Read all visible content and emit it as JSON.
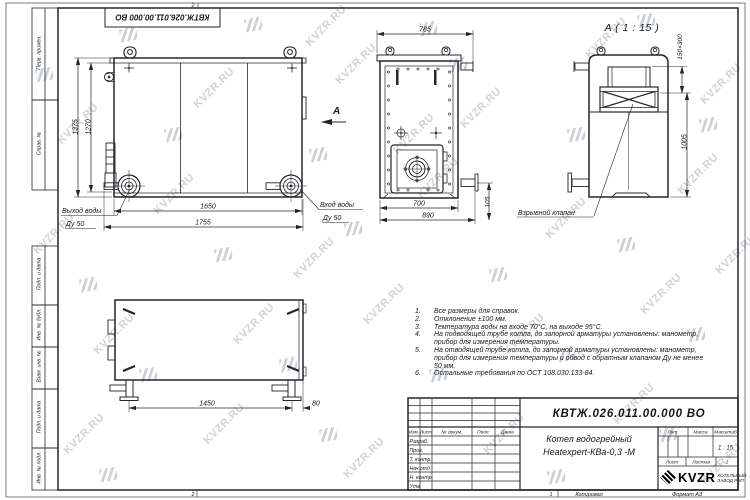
{
  "sheet": {
    "doc_box_top": "КВТЖ.026.011.00.000 ВО",
    "zone_top": "2",
    "zone_bottom_left": "2",
    "zone_bottom_right": "1",
    "copied_label": "Копировал",
    "format_label": "Формат А3"
  },
  "margin": {
    "perv": "Перв. примен.",
    "sprav": "Справ. №",
    "podp1": "Подп. и дата",
    "inv_dubl": "Инв. № дубл.",
    "vzam": "Взам. инв. №",
    "podp2": "Подп. и дата",
    "inv_podl": "Инв. № подл."
  },
  "front": {
    "dim_1375": "1375",
    "dim_1270": "1270",
    "dim_1650": "1650",
    "dim_1755": "1755",
    "outlet_line1": "Выход воды",
    "outlet_line2": "Ду 50",
    "inlet_line1": "Вход воды",
    "inlet_line2": "Ду 50",
    "arrow_label": "A"
  },
  "side": {
    "dim_785": "785",
    "dim_700": "700",
    "dim_890": "890",
    "dim_105": "105"
  },
  "viewA": {
    "title": "A ( 1 : 15 )",
    "dim_valve": "150×300",
    "dim_1005": "1005",
    "valve_label": "Взрывной клапан"
  },
  "bottom_view": {
    "dim_1450": "1450",
    "dim_80": "80"
  },
  "notes": [
    {
      "num": "1.",
      "text": "Все размеры для справок."
    },
    {
      "num": "2.",
      "text": "Отклонение ±100 мм."
    },
    {
      "num": "3.",
      "text": "Температура воды на входе 70°С, на выходе 95°С."
    },
    {
      "num": "4.",
      "text": "На подводящей трубе котла, до запорной арматуры установлены: манометр, прибор для измерения температуры."
    },
    {
      "num": "5.",
      "text": "На отводящей трубе котла, до запорной арматуры установлены: манометр, прибор для измерения температуры и обвод с обратным клапаном Ду не менее 50 мм."
    },
    {
      "num": "6.",
      "text": "Остальные требования по ОСТ 108.030.133-84."
    }
  ],
  "title_block": {
    "doc_number": "КВТЖ.026.011.00.000 ВО",
    "name_line1": "Котел водогрейный",
    "name_line2": "Heatexpert-КВа-0,3 -М",
    "col_izm": "Изм.",
    "col_list": "Лист",
    "col_dok": "№ докум.",
    "col_podp": "Подп.",
    "col_data": "Дата",
    "row_razrab": "Разраб.",
    "row_prov": "Пров.",
    "row_tkontr": "Т. контр.",
    "row_nachotd": "Нач.отд.",
    "row_nkontr": "Н. контр.",
    "row_utv": "Утв.",
    "lit_label": "Лит.",
    "mass_label": "Масса",
    "scale_label": "Масштаб",
    "scale_value": "1 : 15",
    "list_label": "Лист",
    "listov_label": "Листов",
    "listov_value": "1",
    "brand": "KVZR",
    "brand_line1": "КОТЕЛЬНЫЙ",
    "brand_line2": "ЗАВОД РЭП"
  },
  "watermark": {
    "text": "KVZR.RU"
  }
}
